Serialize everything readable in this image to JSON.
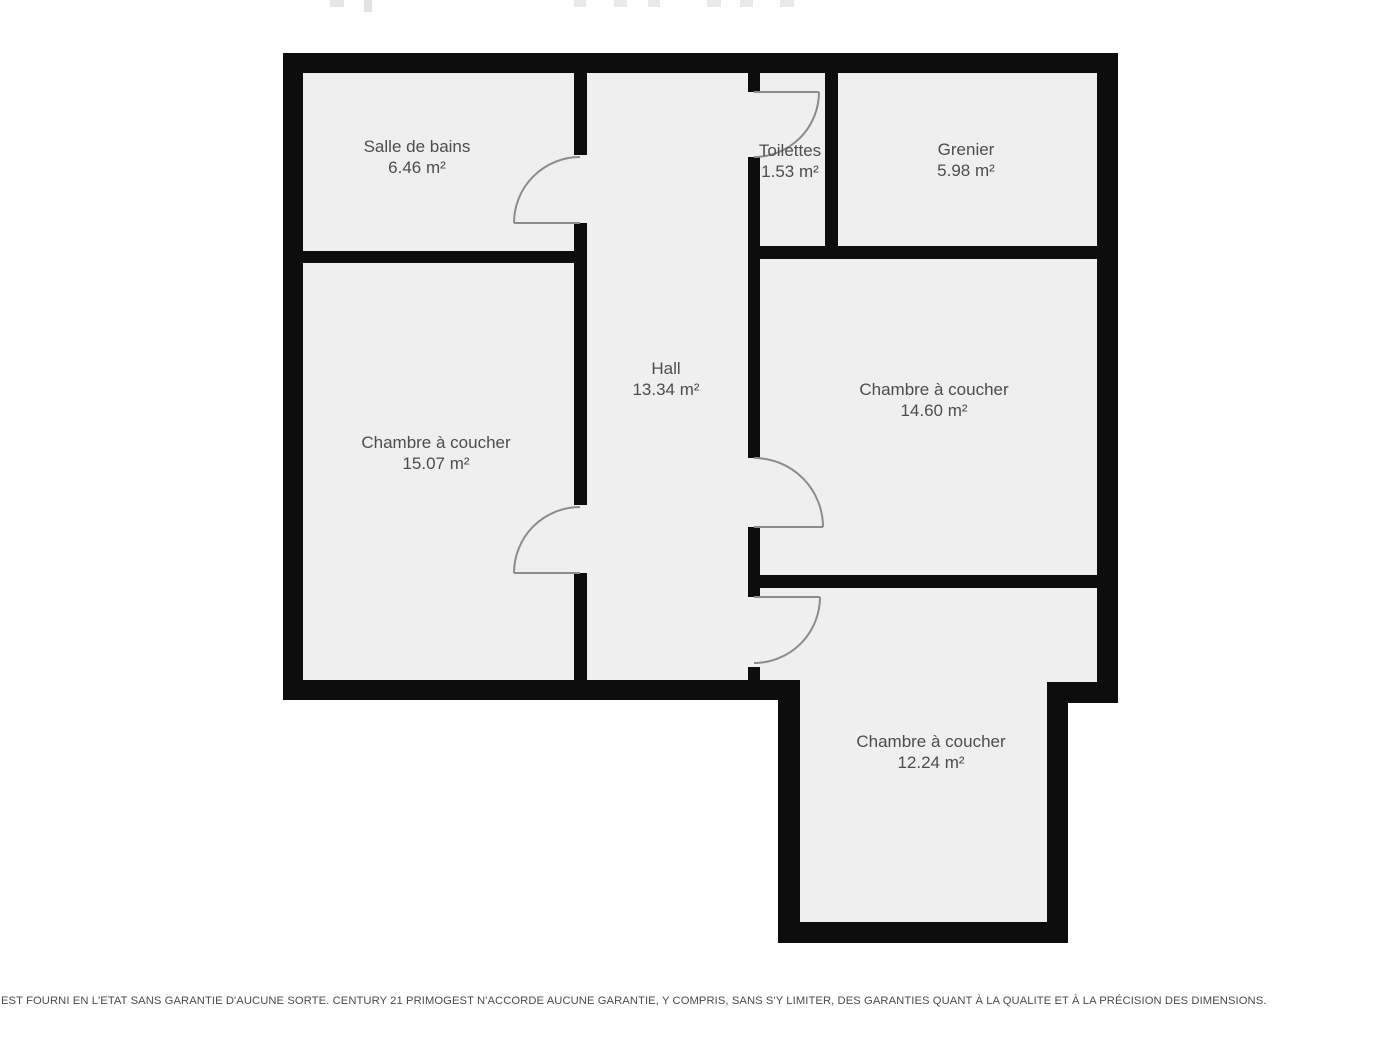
{
  "plan": {
    "rooms": [
      {
        "name": "Salle de bains",
        "area": "6.46 m²"
      },
      {
        "name": "Toilettes",
        "area": "1.53 m²"
      },
      {
        "name": "Grenier",
        "area": "5.98 m²"
      },
      {
        "name": "Hall",
        "area": "13.34 m²"
      },
      {
        "name": "Chambre à coucher",
        "area": "15.07 m²"
      },
      {
        "name": "Chambre à coucher",
        "area": "14.60 m²"
      },
      {
        "name": "Chambre à coucher",
        "area": "12.24 m²"
      }
    ],
    "colors": {
      "wall": "#0d0d0d",
      "floor": "#efefef",
      "label_text": "#4d4d4d",
      "door_line": "#8c8c8c"
    }
  },
  "footer": {
    "disclaimer": "EST FOURNI EN L'ETAT SANS GARANTIE D'AUCUNE SORTE. CENTURY 21 PRIMOGEST N'ACCORDE AUCUNE GARANTIE, Y COMPRIS, SANS S'Y LIMITER, DES GARANTIES QUANT À LA QUALITE ET À LA PRÉCISION DES DIMENSIONS."
  }
}
